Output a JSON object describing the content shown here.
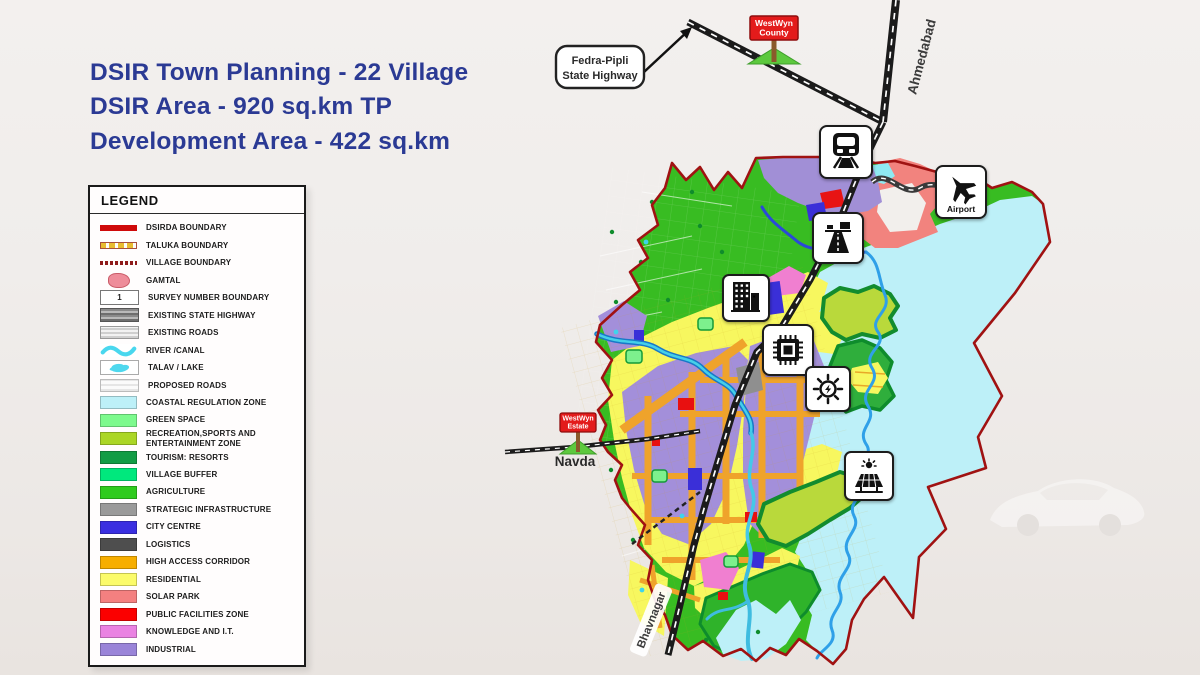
{
  "title": {
    "line1": "DSIR Town Planning - 22 Village",
    "line2": "DSIR Area - 920 sq.km TP",
    "line3": "Development Area - 422 sq.km"
  },
  "legend": {
    "title": "LEGEND",
    "items": [
      {
        "label": "DSIRDA BOUNDARY",
        "type": "line-red",
        "color": "#CF0A0A"
      },
      {
        "label": "TALUKA BOUNDARY",
        "type": "squares",
        "color": "#E8BC30"
      },
      {
        "label": "VILLAGE BOUNDARY",
        "type": "dots-red",
        "color": "#8E1A1A"
      },
      {
        "label": "GAMTAL",
        "type": "blob-pink",
        "color": "#EE8D9A"
      },
      {
        "label": "SURVEY NUMBER BOUNDARY",
        "type": "survey",
        "number": "1"
      },
      {
        "label": "EXISTING STATE HIGHWAY",
        "type": "hwy-dark",
        "color": "#6E6E6E"
      },
      {
        "label": "EXISTING ROADS",
        "type": "roads",
        "color": "#CFCFCF"
      },
      {
        "label": "RIVER /CANAL",
        "type": "wave",
        "color": "#49D7EE"
      },
      {
        "label": "TALAV / LAKE",
        "type": "lake",
        "color": "#4ED8EE"
      },
      {
        "label": "PROPOSED ROADS",
        "type": "proposed",
        "color": "#E6E6E6"
      },
      {
        "label": "COASTAL REGULATION ZONE",
        "type": "fill",
        "color": "#BDF0F8"
      },
      {
        "label": "GREEN SPACE",
        "type": "fill",
        "color": "#7DFA8D"
      },
      {
        "label": "RECREATION,SPORTS AND ENTERTAINMENT ZONE",
        "type": "fill",
        "color": "#ABD626"
      },
      {
        "label": "TOURISM: RESORTS",
        "type": "fill",
        "color": "#129C45"
      },
      {
        "label": "VILLAGE BUFFER",
        "type": "fill",
        "color": "#00E87D"
      },
      {
        "label": "AGRICULTURE",
        "type": "fill",
        "color": "#2FCB1E"
      },
      {
        "label": "STRATEGIC INFRASTRUCTURE",
        "type": "fill",
        "color": "#9A9A9A"
      },
      {
        "label": "CITY CENTRE",
        "type": "fill",
        "color": "#3A2FE0"
      },
      {
        "label": "LOGISTICS",
        "type": "fill",
        "color": "#4E4E4E"
      },
      {
        "label": "HIGH ACCESS CORRIDOR",
        "type": "fill",
        "color": "#F7AE00"
      },
      {
        "label": "RESIDENTIAL",
        "type": "fill",
        "color": "#FBFB6A"
      },
      {
        "label": "SOLAR PARK",
        "type": "fill",
        "color": "#F48080"
      },
      {
        "label": "PUBLIC FACILITIES ZONE",
        "type": "fill",
        "color": "#FB0000"
      },
      {
        "label": "KNOWLEDGE AND I.T.",
        "type": "fill",
        "color": "#EA82E2"
      },
      {
        "label": "INDUSTRIAL",
        "type": "fill",
        "color": "#9A84D8"
      }
    ]
  },
  "map": {
    "callout": {
      "line1": "Fedra-Pipli",
      "line2": "State Highway"
    },
    "signs": {
      "county": {
        "line1": "WestWyn",
        "line2": "County"
      },
      "estate": {
        "line1": "WestWyn",
        "line2": "Estate"
      }
    },
    "labels": {
      "ahmedabad": "Ahmedabad",
      "bhavnagar": "Bhavnagar",
      "navda": "Navda",
      "airport": "Airport"
    },
    "icons": [
      "train-station",
      "airport",
      "expressway",
      "city-centre",
      "semiconductor",
      "power-plant",
      "solar-park"
    ]
  },
  "colors": {
    "title_text": "#2B3A94",
    "boundary": "#A01212",
    "highway": "#1B1B1B",
    "sign_red": "#E31B1B"
  }
}
